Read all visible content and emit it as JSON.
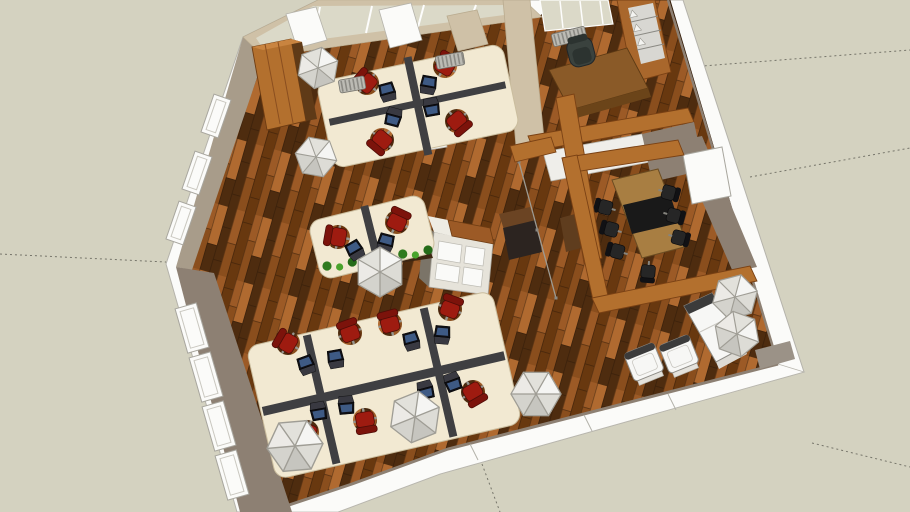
{
  "scene": {
    "type": "3d-floorplan-model",
    "description": "Bird's-eye 3D model of an open-plan office: cream workstation pods with red task chairs and laptops, a timber-framed conference room with dark chairs, a private office, a white lounge set, storage cabinets and faceted white pendant lamps over dark wood plank flooring.",
    "rooms": [
      "open-plan-office",
      "conference-room",
      "private-office",
      "lounge"
    ],
    "palette": {
      "bg": "#d4d2c0",
      "band_white": "#fbfbf9",
      "glass": "#dbd9c8",
      "wall_beige": "#cfc1a7",
      "wall_taupe": "#8d8073",
      "wall_taupe_light": "#a89c8a",
      "wood_beam": "#b3702e",
      "wood_beam_dark": "#7a4114",
      "desk_cream": "#f2e9d2",
      "divider_dark": "#3f3f42",
      "chair_red": "#9e1b10",
      "chair_red_dark": "#7c130b",
      "conference_table": "#a87e42",
      "table_black": "#191919",
      "chair_black": "#262626",
      "lounge_white": "#f7f7f5",
      "plant_green": "#3d8f25",
      "floor_1": "#4e2c0f",
      "floor_2": "#7a4419",
      "floor_3": "#9c5a26",
      "floor_4": "#68380f",
      "floor_5": "#8a4e1d",
      "floor_6": "#b06a30"
    },
    "guide_lines": [
      [
        0,
        254,
        166,
        262
      ],
      [
        625,
        72,
        910,
        50
      ],
      [
        750,
        177,
        910,
        148
      ],
      [
        812,
        443,
        910,
        467
      ],
      [
        482,
        464,
        500,
        512
      ]
    ],
    "pendant_lamps": [
      [
        318,
        68,
        21,
        10
      ],
      [
        316,
        157,
        21,
        40
      ],
      [
        380,
        272,
        25,
        0
      ],
      [
        295,
        446,
        28,
        25
      ],
      [
        415,
        417,
        26,
        8
      ],
      [
        536,
        394,
        25,
        30
      ],
      [
        735,
        297,
        23,
        15
      ],
      [
        737,
        334,
        23,
        50
      ]
    ],
    "desk_pods": [
      {
        "cx": 418,
        "cy": 106,
        "w": 190,
        "h": 88,
        "a": -12,
        "seats": 4,
        "spines": [
          {
            "x": -4,
            "y": -50,
            "w": 8,
            "h": 100
          },
          {
            "x": -90,
            "y": -6,
            "w": 180,
            "h": 7
          }
        ]
      },
      {
        "cx": 372,
        "cy": 237,
        "w": 118,
        "h": 60,
        "a": -14,
        "seats": 2,
        "spines": [
          {
            "x": -4,
            "y": -32,
            "w": 8,
            "h": 64
          }
        ]
      },
      {
        "cx": 384,
        "cy": 385,
        "w": 252,
        "h": 136,
        "a": -13,
        "seats": 8,
        "spines": [
          {
            "x": -124,
            "y": -6,
            "w": 248,
            "h": 9
          },
          {
            "x": -68,
            "y": -66,
            "w": 8,
            "h": 132
          },
          {
            "x": 52,
            "y": -66,
            "w": 8,
            "h": 132
          }
        ]
      }
    ],
    "task_chairs": [
      [
        367,
        83,
        -50
      ],
      [
        445,
        66,
        30
      ],
      [
        382,
        140,
        -140
      ],
      [
        457,
        121,
        140
      ],
      [
        338,
        237,
        -80
      ],
      [
        397,
        222,
        25
      ],
      [
        288,
        343,
        -60
      ],
      [
        350,
        333,
        -20
      ],
      [
        390,
        324,
        -15
      ],
      [
        450,
        309,
        20
      ],
      [
        307,
        432,
        -160
      ],
      [
        365,
        420,
        170
      ],
      [
        420,
        407,
        165
      ],
      [
        473,
        392,
        150
      ]
    ],
    "laptops": [
      [
        388,
        94,
        -15
      ],
      [
        428,
        87,
        10
      ],
      [
        431,
        105,
        170
      ],
      [
        394,
        115,
        195
      ],
      [
        356,
        252,
        -30
      ],
      [
        385,
        245,
        15
      ],
      [
        307,
        367,
        -20
      ],
      [
        336,
        361,
        -10
      ],
      [
        412,
        343,
        -15
      ],
      [
        442,
        337,
        5
      ],
      [
        318,
        409,
        170
      ],
      [
        346,
        403,
        175
      ],
      [
        425,
        388,
        165
      ],
      [
        452,
        380,
        160
      ]
    ],
    "conference_chairs": [
      [
        604,
        207,
        -75
      ],
      [
        610,
        229,
        -75
      ],
      [
        616,
        251,
        -75
      ],
      [
        670,
        193,
        105
      ],
      [
        675,
        216,
        105
      ],
      [
        680,
        238,
        105
      ],
      [
        648,
        273,
        185
      ]
    ],
    "lounge_armchairs": [
      [
        644,
        362,
        -22
      ],
      [
        679,
        354,
        -22
      ]
    ],
    "radiators": [
      [
        352,
        84,
        -10,
        26
      ],
      [
        450,
        60,
        -10,
        28
      ],
      [
        569,
        36,
        -14,
        34
      ]
    ],
    "window_frames": [
      [
        192,
        328,
        74,
        46,
        22
      ],
      [
        206,
        377,
        74,
        46,
        22
      ],
      [
        219,
        426,
        74,
        46,
        22
      ],
      [
        232,
        475,
        74,
        46,
        22
      ],
      [
        216,
        116,
        109,
        40,
        18
      ],
      [
        197,
        173,
        109,
        40,
        18
      ],
      [
        181,
        223,
        109,
        40,
        18
      ]
    ],
    "shelf_bookends": [
      [
        633,
        14
      ],
      [
        637,
        28
      ],
      [
        641,
        42
      ]
    ],
    "plants": {
      "x1": 327,
      "y1": 267,
      "x2": 428,
      "y2": 251,
      "count": 9
    }
  }
}
